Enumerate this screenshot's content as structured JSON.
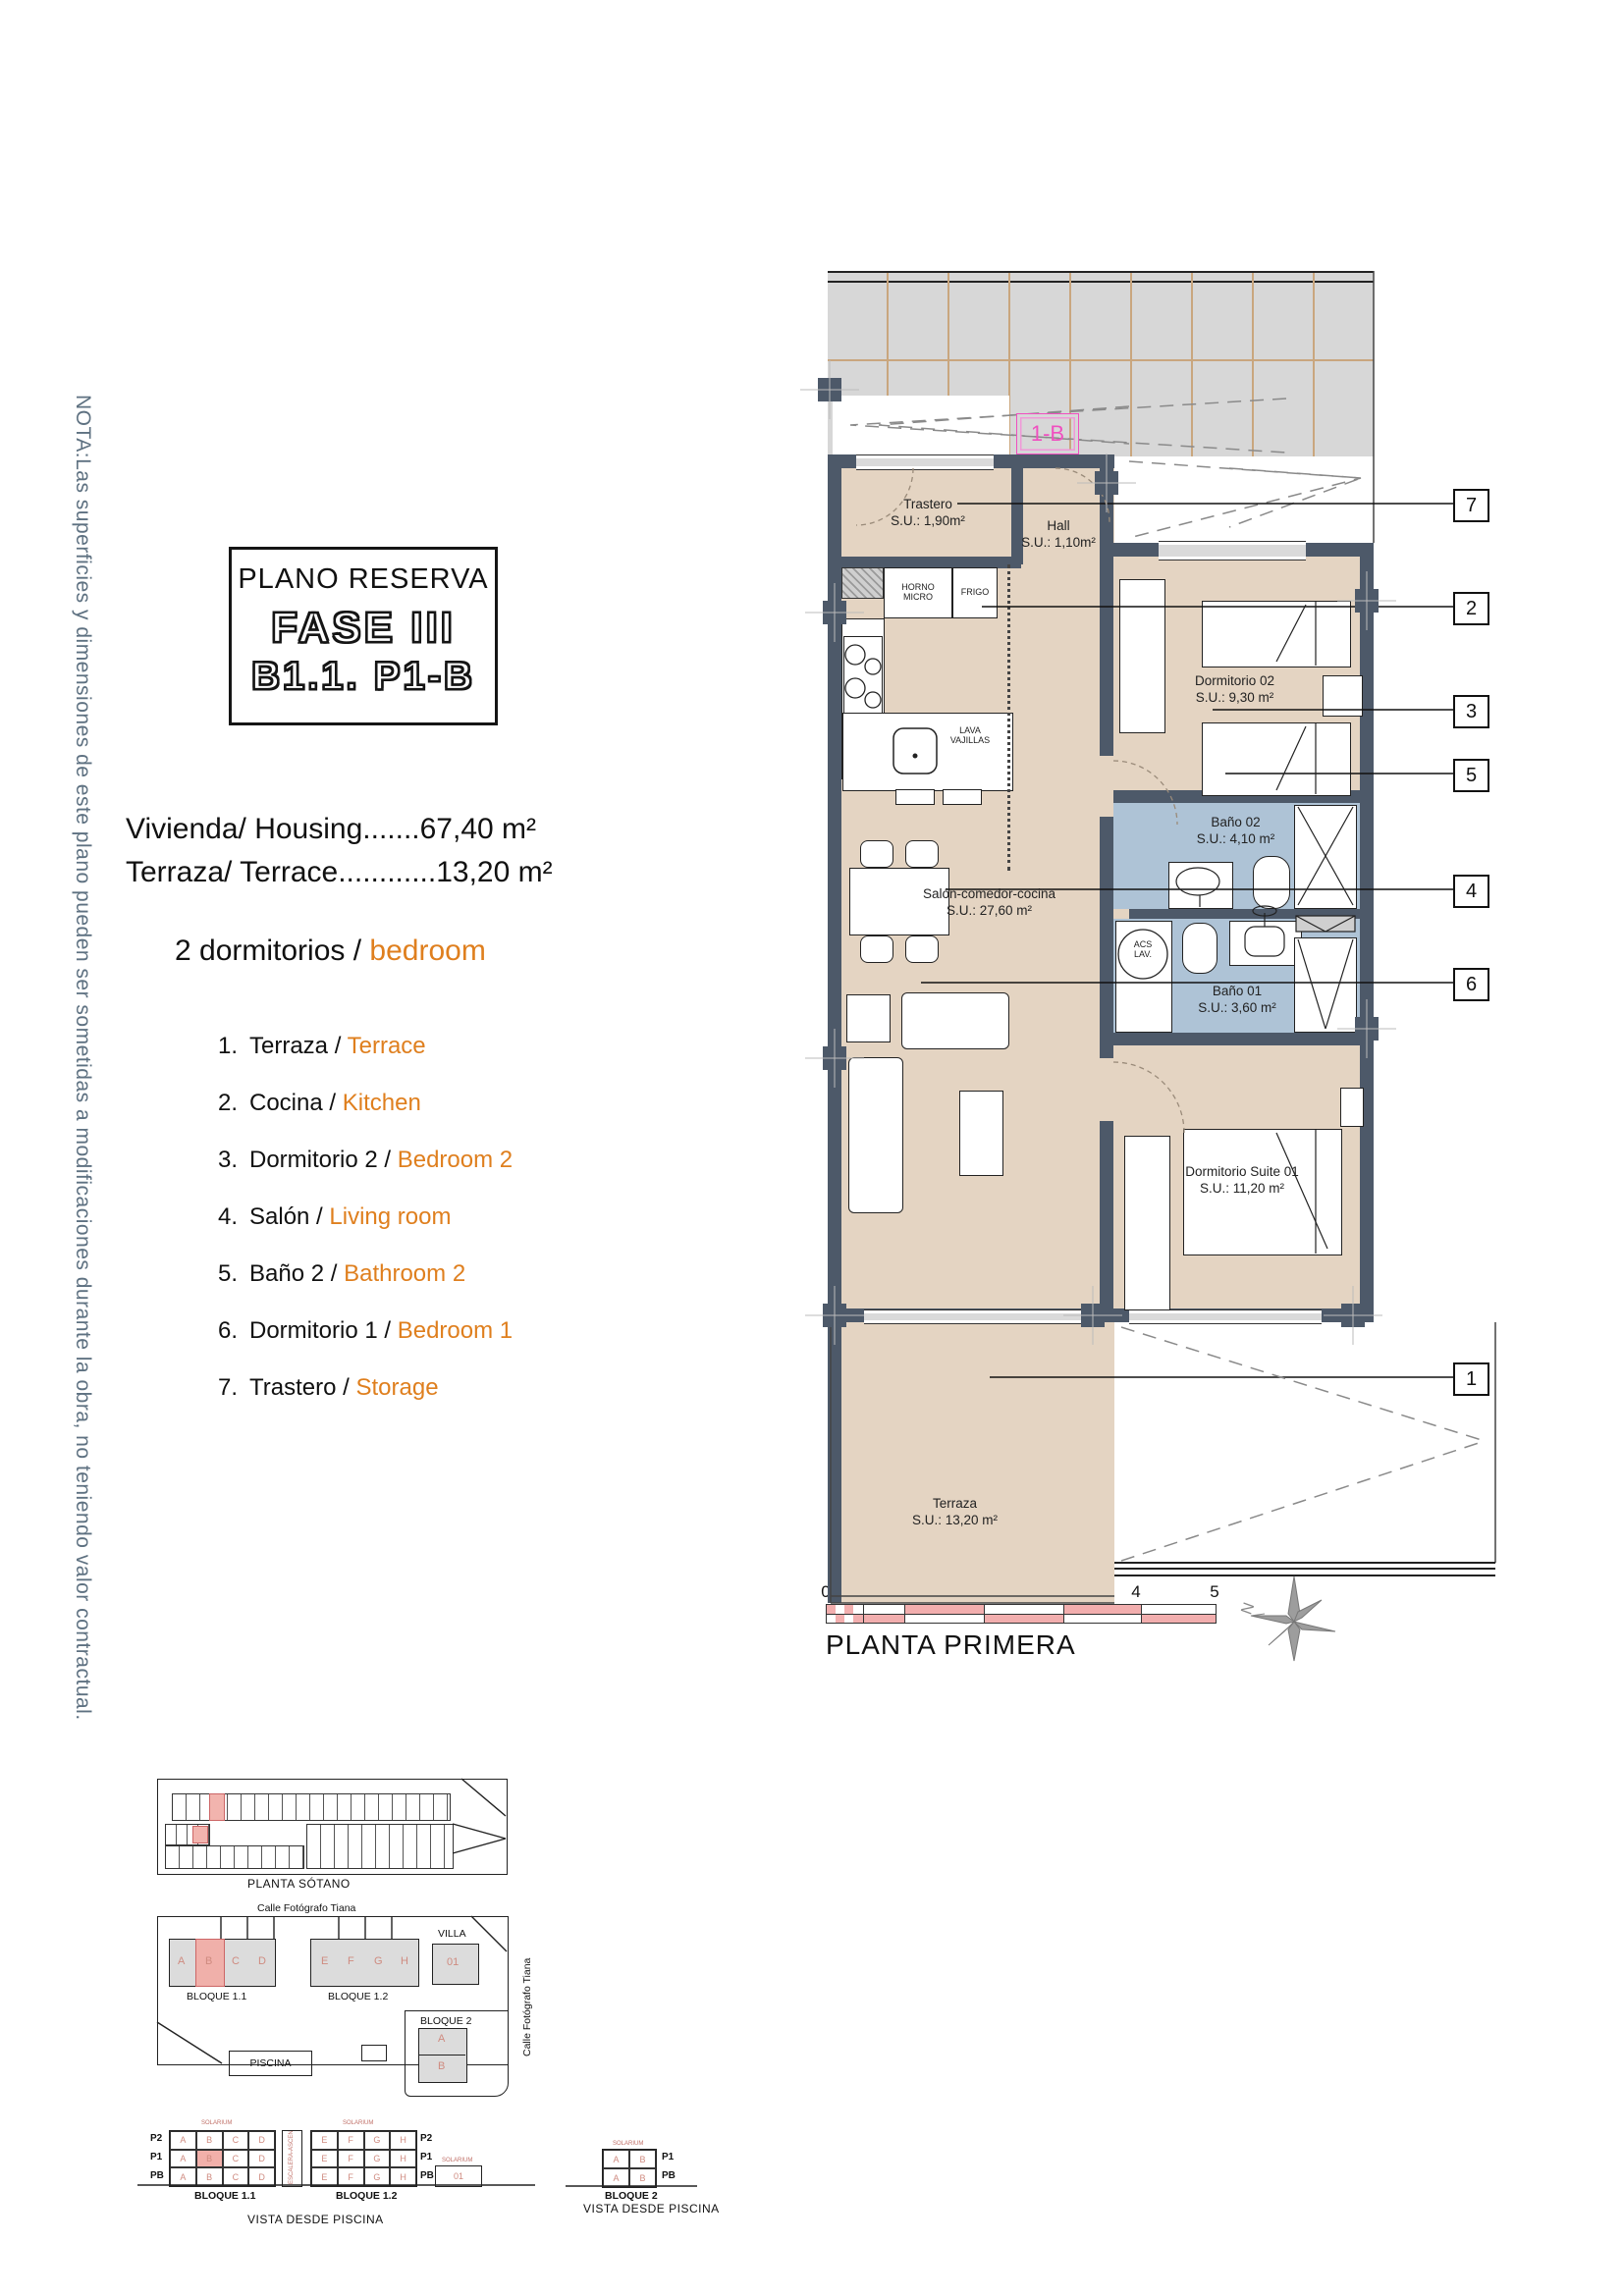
{
  "note": "NOTA:Las superficies y dimensiones de este plano pueden ser sometidas a modificaciones durante la obra, no teniendo valor contractual.",
  "title": {
    "line1": "PLANO RESERVA",
    "fase": "FASE III",
    "unit": "B1.1. P1-B"
  },
  "summary": {
    "housing_line": "Vivienda/ Housing.......67,40 m²",
    "terrace_line": "Terraza/ Terrace............13,20 m²",
    "bedrooms_es": "2 dormitorios",
    "sep": " / ",
    "bedrooms_en": "bedroom"
  },
  "legend": {
    "items": [
      {
        "n": "1.",
        "es": "Terraza",
        "en": "Terrace"
      },
      {
        "n": "2.",
        "es": "Cocina",
        "en": "Kitchen"
      },
      {
        "n": "3.",
        "es": "Dormitorio 2",
        "en": "Bedroom 2"
      },
      {
        "n": "4.",
        "es": "Salón",
        "en": "Living room"
      },
      {
        "n": "5.",
        "es": "Baño 2",
        "en": "Bathroom 2"
      },
      {
        "n": "6.",
        "es": "Dormitorio 1",
        "en": "Bedroom 1"
      },
      {
        "n": "7.",
        "es": "Trastero",
        "en": "Storage"
      }
    ]
  },
  "plan": {
    "unit_tag": "1-B",
    "rooms": {
      "trastero": {
        "name": "Trastero",
        "area": "S.U.: 1,90m²"
      },
      "hall": {
        "name": "Hall",
        "area": "S.U.: 1,10m²"
      },
      "salon": {
        "name": "Salón-comedor-cocina",
        "area": "S.U.: 27,60 m²"
      },
      "dorm02": {
        "name": "Dormitorio 02",
        "area": "S.U.: 9,30 m²"
      },
      "bano02": {
        "name": "Baño 02",
        "area": "S.U.: 4,10 m²"
      },
      "bano01": {
        "name": "Baño 01",
        "area": "S.U.: 3,60 m²"
      },
      "suite": {
        "name": "Dormitorio Suite 01",
        "area": "S.U.: 11,20 m²"
      },
      "terraza": {
        "name": "Terraza",
        "area": "S.U.: 13,20 m²"
      }
    },
    "appliances": {
      "horno1": "HORNO",
      "horno2": "MICRO",
      "frigo": "FRIGO",
      "lava1": "LAVA",
      "lava2": "VAJILLAS",
      "acs1": "ACS",
      "acs2": "LAV."
    },
    "callouts": [
      "7",
      "2",
      "3",
      "5",
      "4",
      "6",
      "1"
    ]
  },
  "scalebar": {
    "ticks": [
      "0",
      "0.5",
      "1",
      "2",
      "3",
      "4",
      "5"
    ],
    "caption": "PLANTA PRIMERA",
    "north": "N"
  },
  "site": {
    "garage_caption": "PLANTA SÓTANO",
    "street_top": "Calle Fotógrafo Tiana",
    "street_right": "Calle Fotógrafo Tiana",
    "b11": {
      "label": "BLOQUE 1.1",
      "units": [
        "A",
        "B",
        "C",
        "D"
      ]
    },
    "b12": {
      "label": "BLOQUE 1.2",
      "units": [
        "E",
        "F",
        "G",
        "H"
      ]
    },
    "villa": {
      "label": "VILLA",
      "unit": "01"
    },
    "b2": {
      "label": "BLOQUE 2",
      "units": [
        "A",
        "B"
      ]
    },
    "piscina": "PISCINA"
  },
  "elevations": {
    "rows": [
      "P2",
      "P1",
      "PB"
    ],
    "rows_b2": [
      "P1",
      "PB"
    ],
    "b11_label": "BLOQUE 1.1",
    "b12_label": "BLOQUE 1.2",
    "b2_label": "BLOQUE 2",
    "caption": "VISTA DESDE PISCINA",
    "caption2": "VISTA DESDE PISCINA",
    "solarium": "SOLARIUM",
    "shaft": "ESCALERA-ASCENSOR",
    "unit01": "01",
    "pb": "PB"
  }
}
